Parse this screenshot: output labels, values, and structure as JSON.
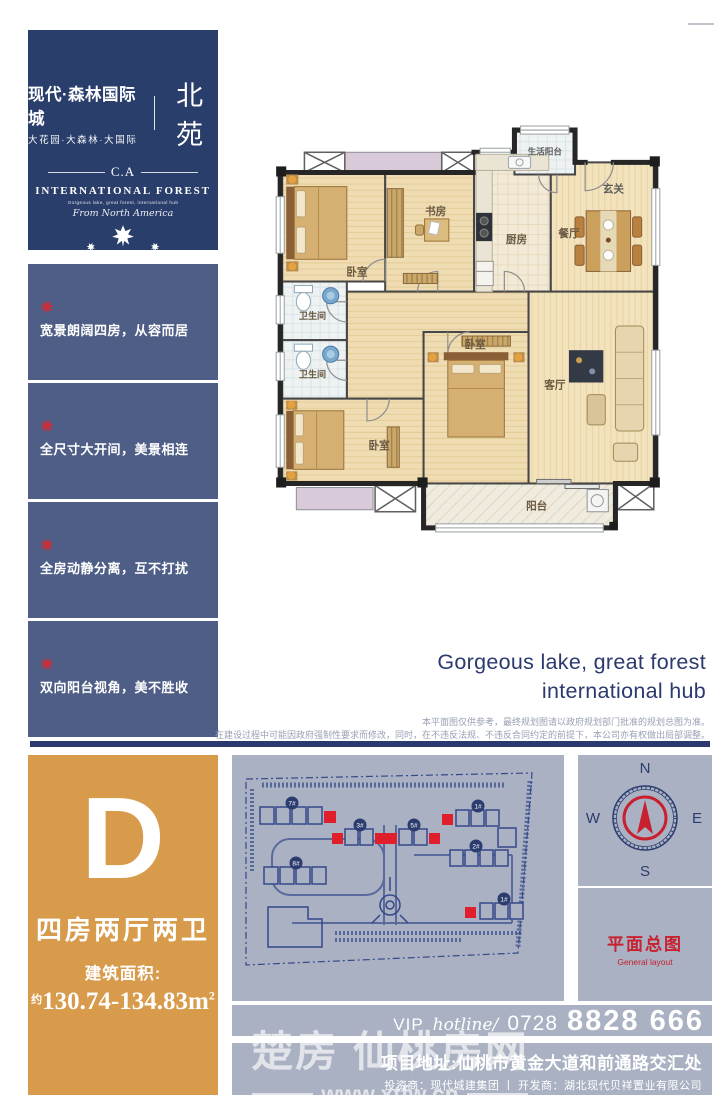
{
  "brand": {
    "title": "现代·森林国际城",
    "subtitle": "大花园·大森林·大国际",
    "name_tag": "北苑",
    "monogram": "C.A",
    "en_title": "INTERNATIONAL FOREST",
    "en_tagline": "Gorgeous lake, great forest, international hub",
    "script_line": "From North America"
  },
  "features": [
    {
      "text": "宽景朗阔四房，从容而居"
    },
    {
      "text": "全尺寸大开间，美景相连"
    },
    {
      "text": "全房动静分离，互不打扰"
    },
    {
      "text": "双向阳台视角，美不胜收"
    }
  ],
  "floorplan": {
    "rooms": [
      "卧室",
      "书房",
      "厨房",
      "餐厅",
      "玄关",
      "生活阳台",
      "卫生间",
      "卫生间",
      "卧室",
      "卧室",
      "客厅",
      "阳台"
    ]
  },
  "right_text": {
    "headline_line1": "Gorgeous lake, great forest",
    "headline_line2": "international hub",
    "disclaimer_line1": "本平面图仅供参考，最终规划图请以政府规划部门批准的规划总图为准。",
    "disclaimer_line2": "在建设过程中可能因政府强制性要求而修改，同时，在不违反法规、不违反合同约定的前提下，本公司亦有权做出局部调整。"
  },
  "unit": {
    "type_letter": "D",
    "layout": "四房两厅两卫",
    "area_label": "建筑面积:",
    "area_prefix": "约",
    "area_value": "130.74-134.83",
    "area_unit": "m",
    "area_power": "2"
  },
  "siteplan": {
    "badges": [
      "7#",
      "3#",
      "5#",
      "1#",
      "2#",
      "8#",
      "1#"
    ]
  },
  "compass": {
    "n": "N",
    "e": "E",
    "s": "S",
    "w": "W"
  },
  "layout_caption": {
    "title": "平面总图",
    "subtitle": "General layout"
  },
  "hotline": {
    "vip": "VIP",
    "hotline": "hotline/",
    "prefix": "0728",
    "number": "8828 666"
  },
  "footer": {
    "address": "项目地址:仙桃市黄金大道和前通路交汇处",
    "credits": "投资商：现代城建集团 丨 开发商：湖北现代贝祥置业有限公司"
  },
  "watermark": {
    "text": "楚房 仙桃房网",
    "url": "www.xtfw.cn"
  },
  "colors": {
    "navy": "#2a3e6c",
    "slate": "#4e5e86",
    "orange": "#d79b4b",
    "panel_gray": "#a9b1c2",
    "accent_red": "#c8202f",
    "navy_text": "#2b3a6e"
  }
}
